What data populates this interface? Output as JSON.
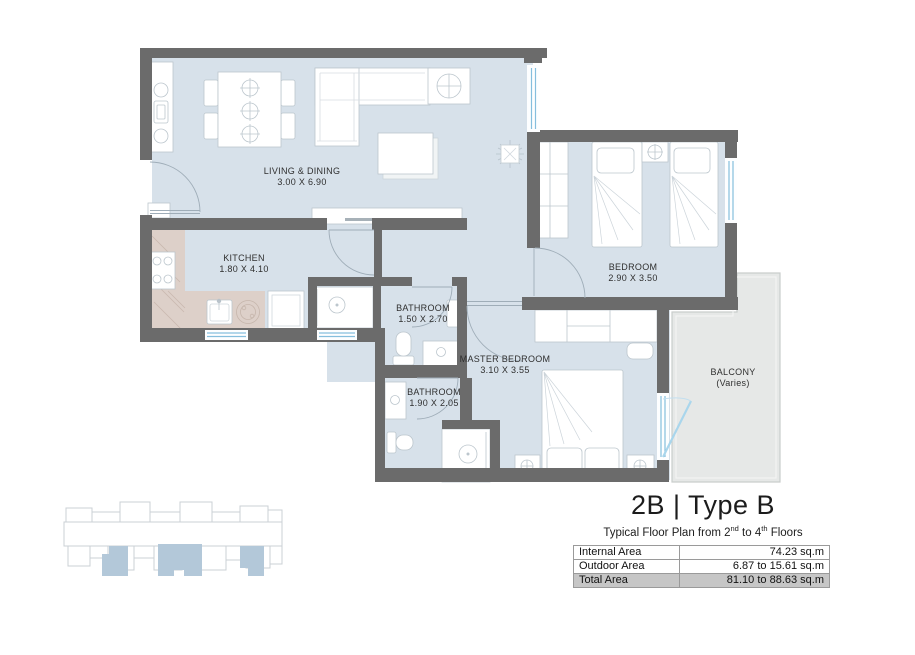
{
  "floor_plan": {
    "rooms": [
      {
        "name": "LIVING & DINING",
        "dims": "3.00 X 6.90"
      },
      {
        "name": "KITCHEN",
        "dims": "1.80 X 4.10"
      },
      {
        "name": "BATHROOM",
        "dims": "1.50 X 2.70"
      },
      {
        "name": "BEDROOM",
        "dims": "2.90 X 3.50"
      },
      {
        "name": "MASTER BEDROOM",
        "dims": "3.10 X 3.55"
      },
      {
        "name": "BATHROOM",
        "dims": "1.90 X 2.05"
      },
      {
        "name": "BALCONY",
        "dims": "(Varies)"
      }
    ]
  },
  "title_block": {
    "unit_type": "2B | Type B",
    "subtitle": {
      "p1": "Typical Floor Plan from 2",
      "sup1": "nd",
      "p2": " to 4",
      "sup2": "th",
      "p3": " Floors"
    },
    "area_table": {
      "rows": [
        {
          "label": "Internal Area",
          "value": "74.23 sq.m"
        },
        {
          "label": "Outdoor Area",
          "value": "6.87 to 15.61 sq.m"
        },
        {
          "label": "Total Area",
          "value": "81.10 to 88.63 sq.m"
        }
      ]
    }
  },
  "colors": {
    "wall": "#6b6b6b",
    "floor": "#d7e1ea",
    "counter": "#ddd0c9",
    "balcony": "#e6e8e7",
    "window_line": "#85bedd",
    "keyplan_highlight": "#b3c8d9",
    "table_highlight": "#c6c6c6"
  }
}
